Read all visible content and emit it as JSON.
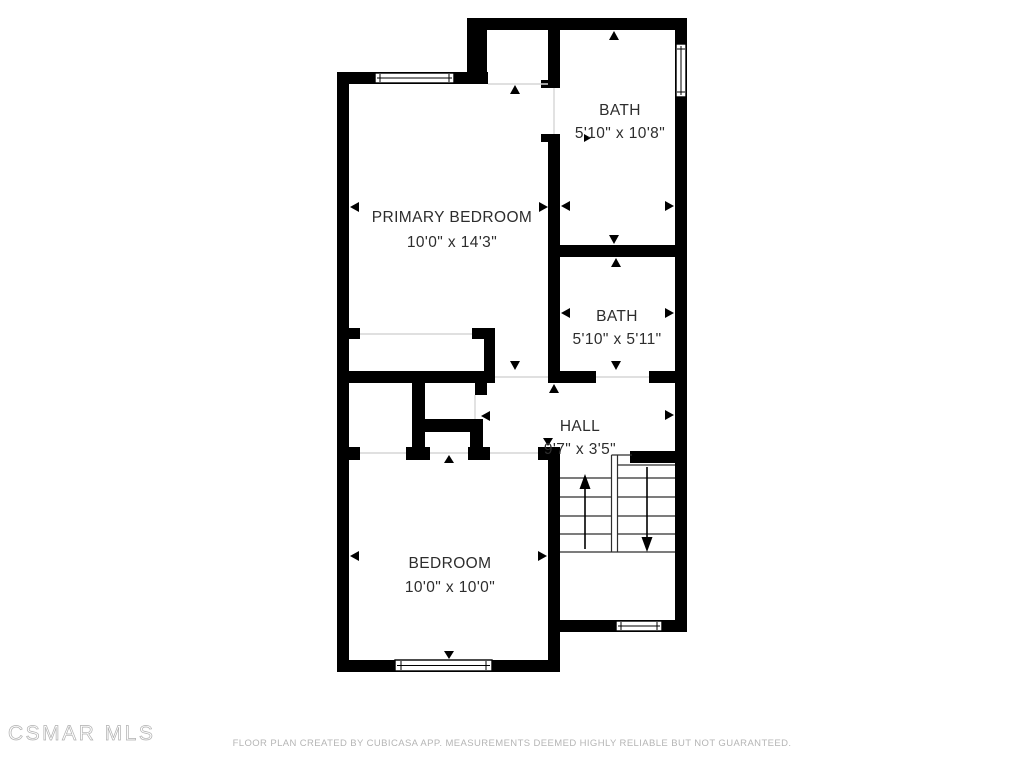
{
  "watermark": "CSMAR MLS",
  "footer_disclaimer": "FLOOR PLAN CREATED BY CUBICASA APP. MEASUREMENTS DEEMED HIGHLY RELIABLE BUT NOT GUARANTEED.",
  "colors": {
    "wall": "#000000",
    "background": "#ffffff",
    "label": "#2d2d2d",
    "muted_text": "#b5b5b5",
    "threshold": "#d6d6d6"
  },
  "rooms": [
    {
      "id": "primary-bedroom",
      "name": "PRIMARY BEDROOM",
      "dimensions": "10'0\" x 14'3\""
    },
    {
      "id": "bath-top",
      "name": "BATH",
      "dimensions": "5'10\" x 10'8\""
    },
    {
      "id": "bath-middle",
      "name": "BATH",
      "dimensions": "5'10\" x 5'11\""
    },
    {
      "id": "hall",
      "name": "HALL",
      "dimensions": "9'7\" x 3'5\""
    },
    {
      "id": "bedroom",
      "name": "BEDROOM",
      "dimensions": "10'0\" x 10'0\""
    }
  ]
}
